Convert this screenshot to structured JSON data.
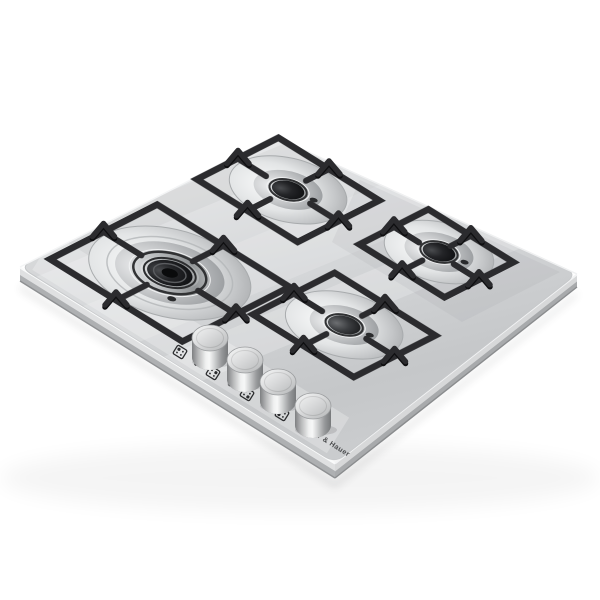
{
  "meta": {
    "type": "product-photo",
    "subject": "Built-in 4-burner gas hob, stainless steel, angled view on white background",
    "background_color": "#ffffff"
  },
  "brand": {
    "label": "Günter & Hauer"
  },
  "colors": {
    "steel_light": "#eceded",
    "steel_mid": "#d3d5d7",
    "steel_dark": "#aeb0b2",
    "grate": "#2b2b2e",
    "grate_shadow": "#131315",
    "burner_cap": "#17181a",
    "chrome": "#c9cbcd",
    "marking": "#2b2c2e"
  },
  "cooktop": {
    "material": "brushed stainless steel",
    "grates": "black cast iron, angular frames with raised pan-support peaks",
    "burners": [
      {
        "name": "left-wok-burner",
        "style": "large double-crown wok burner",
        "cap": "black"
      },
      {
        "name": "back-burner",
        "style": "standard burner",
        "cap": "black"
      },
      {
        "name": "right-burner",
        "style": "standard burner",
        "cap": "black"
      },
      {
        "name": "front-burner",
        "style": "standard burner",
        "cap": "dark gray"
      }
    ],
    "controls": {
      "knob_count": 4,
      "knob_style": "cylindrical stainless knobs on front strip",
      "knobs": [
        {
          "name": "knob-1"
        },
        {
          "name": "knob-2"
        },
        {
          "name": "knob-3"
        },
        {
          "name": "knob-4"
        }
      ],
      "indicator_icons": [
        {
          "name": "burner-position-icon-1"
        },
        {
          "name": "burner-position-icon-2"
        },
        {
          "name": "burner-position-icon-3"
        },
        {
          "name": "burner-position-icon-4"
        }
      ],
      "ignition_dot_count": 4
    }
  }
}
